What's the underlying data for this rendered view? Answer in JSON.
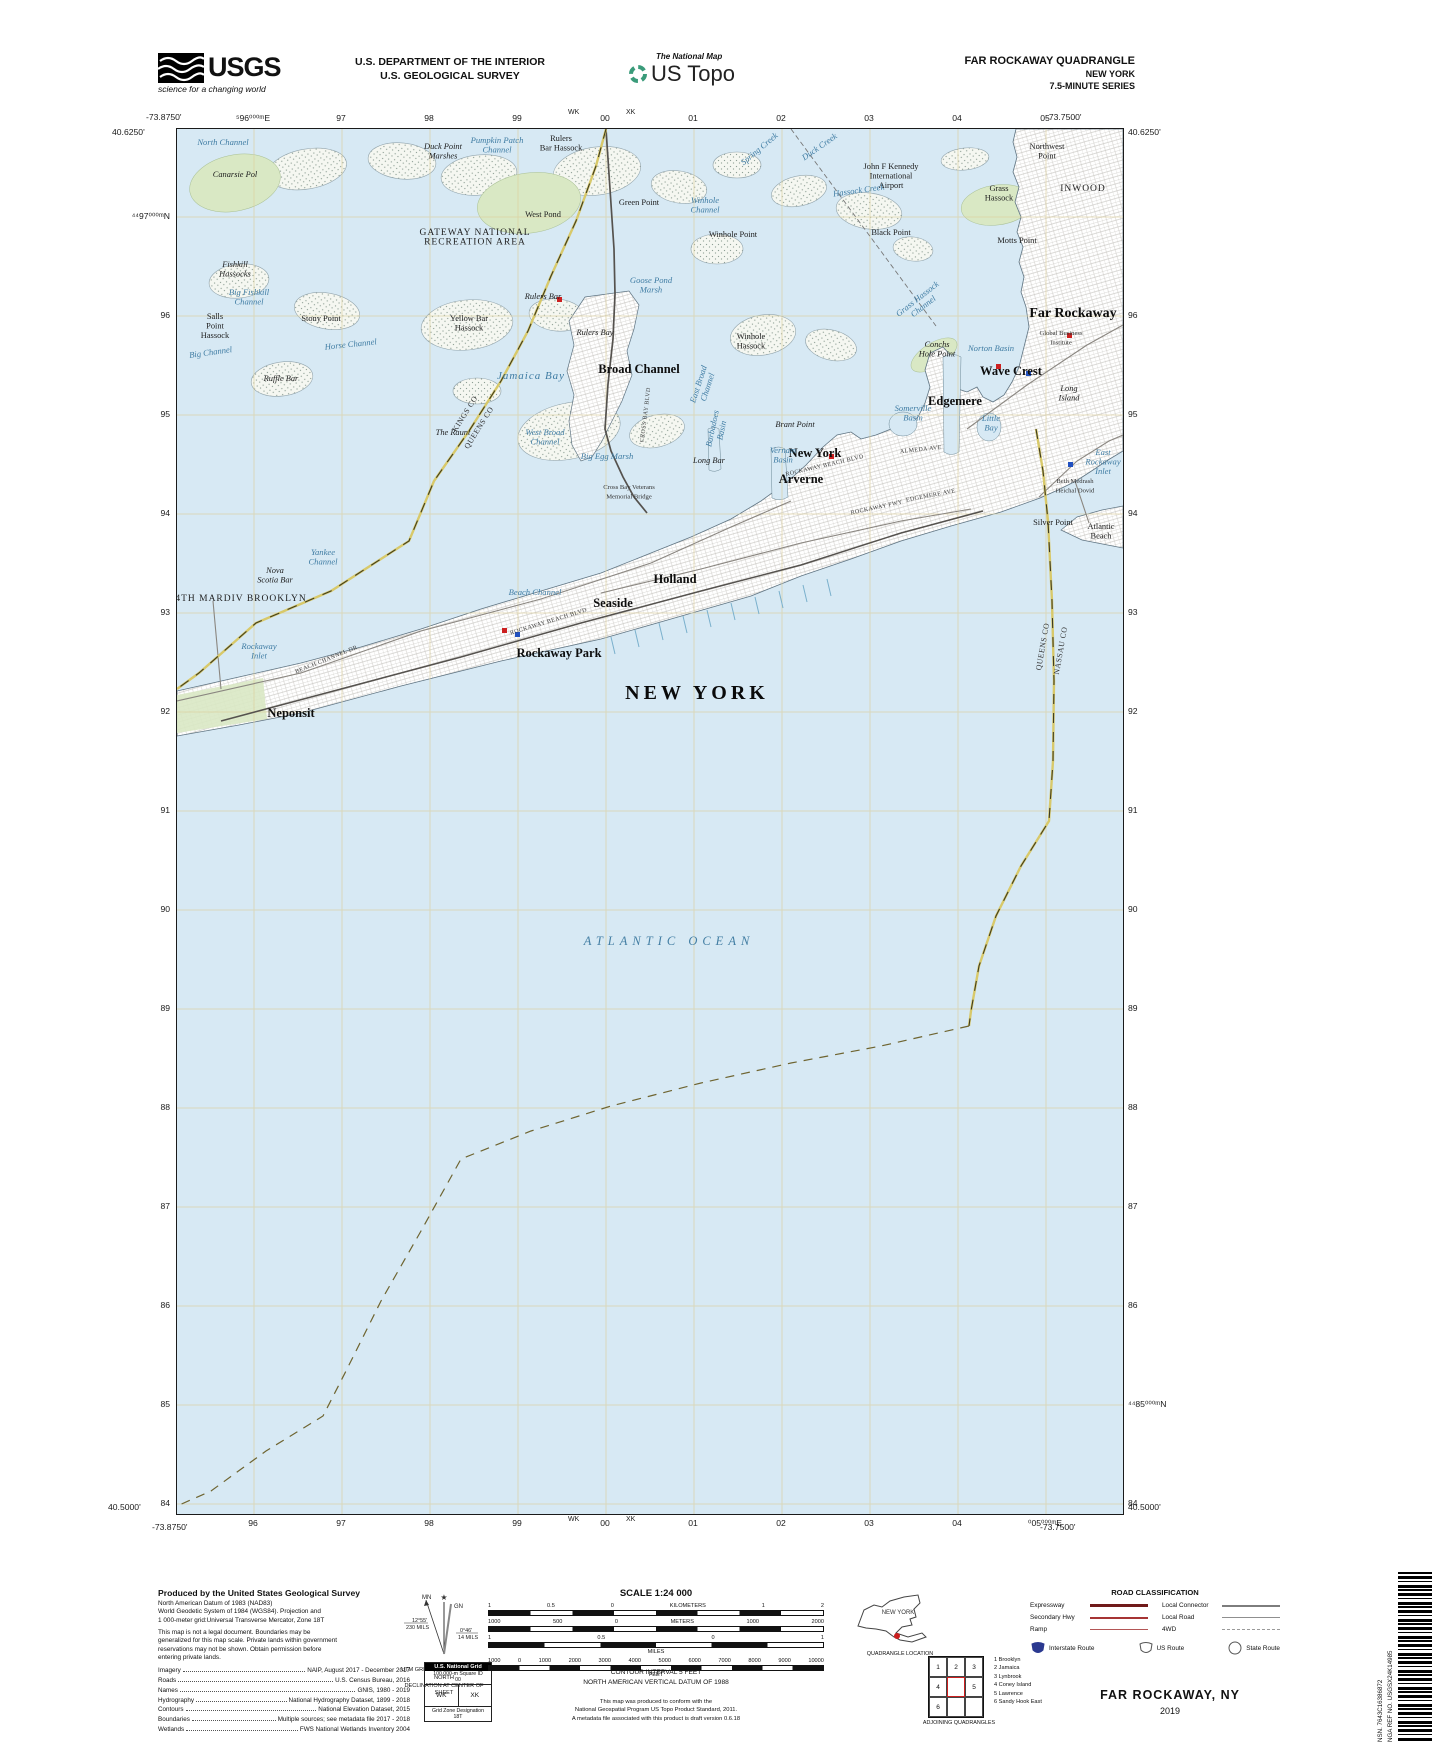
{
  "header": {
    "usgs": "USGS",
    "usgs_tag": "science for a changing world",
    "dept1": "U.S. DEPARTMENT OF THE INTERIOR",
    "dept2": "U.S. GEOLOGICAL SURVEY",
    "tnm": "The National Map",
    "ustopo": "US Topo",
    "quad": "FAR ROCKAWAY QUADRANGLE",
    "state": "NEW YORK",
    "series": "7.5-MINUTE SERIES"
  },
  "colors": {
    "water": "#d7e9f4",
    "grid": "#dccf9d",
    "green": "#d9e8c4",
    "boundary_yellow": "#d8c96a",
    "expressway_red": "#701a1a",
    "interstate_blue": "#2b3990",
    "poi_red": "#cc2020",
    "poi_blue": "#2050c0"
  },
  "map": {
    "corners": {
      "tl_lon": "-73.8750'",
      "tl_lat": "40.6250'",
      "tr_lon": "-73.7500'",
      "tr_lat": "40.6250'",
      "bl_lat": "40.5000'",
      "bl_lon": "-73.8750'",
      "br_lat": "40.5000'",
      "br_lon": "-73.7500'"
    },
    "top_grid": [
      "⁵96⁰⁰⁰ᵐE",
      "97",
      "98",
      "99",
      "00",
      "01",
      "02",
      "03",
      "04",
      "05"
    ],
    "bottom_grid": [
      "96",
      "97",
      "98",
      "99",
      "00",
      "01",
      "02",
      "03",
      "04",
      "⁰05⁰⁰⁰ᵐE"
    ],
    "left_grid": [
      "⁴⁴97⁰⁰⁰ᵐN",
      "96",
      "95",
      "94",
      "93",
      "92",
      "91",
      "90",
      "89",
      "88",
      "87",
      "86",
      "85",
      "84"
    ],
    "right_grid": [
      "96",
      "95",
      "94",
      "93",
      "92",
      "91",
      "90",
      "89",
      "88",
      "87",
      "86",
      "⁴⁴85⁰⁰⁰ᵐN",
      "84"
    ],
    "top_sq": [
      {
        "t": "WK",
        "x": 392
      },
      {
        "t": "XK",
        "x": 450
      }
    ],
    "bottom_sq": [
      {
        "t": "WK",
        "x": 392
      },
      {
        "t": "XK",
        "x": 450
      }
    ],
    "labels": [
      {
        "t": "North Channel",
        "x": 46,
        "y": 16,
        "c": "water"
      },
      {
        "t": "Canarsie Pol",
        "x": 58,
        "y": 48,
        "c": "pitalic"
      },
      {
        "t": "Duck Point\nMarshes",
        "x": 266,
        "y": 20,
        "c": "pitalic"
      },
      {
        "t": "Pumpkin Patch\nChannel",
        "x": 320,
        "y": 14,
        "c": "water"
      },
      {
        "t": "Rulers\nBar Hassock",
        "x": 384,
        "y": 12,
        "c": "place"
      },
      {
        "t": "Green Point",
        "x": 462,
        "y": 76,
        "c": "place"
      },
      {
        "t": "West Pond",
        "x": 366,
        "y": 88,
        "c": "place"
      },
      {
        "t": "Winhole\nChannel",
        "x": 528,
        "y": 74,
        "c": "water"
      },
      {
        "t": "Winhole Point",
        "x": 556,
        "y": 108,
        "c": "place"
      },
      {
        "t": "Spring Creek",
        "x": 584,
        "y": 22,
        "c": "water",
        "r": -40
      },
      {
        "t": "Duck Creek",
        "x": 644,
        "y": 20,
        "c": "water",
        "r": -35
      },
      {
        "t": "Hassock Creek",
        "x": 682,
        "y": 64,
        "c": "water",
        "r": -8
      },
      {
        "t": "John F Kennedy\nInternational\nAirport",
        "x": 714,
        "y": 40,
        "c": "place"
      },
      {
        "t": "Black Point",
        "x": 714,
        "y": 106,
        "c": "place"
      },
      {
        "t": "Grass\nHassock",
        "x": 822,
        "y": 62,
        "c": "place"
      },
      {
        "t": "Motts Point",
        "x": 840,
        "y": 114,
        "c": "place"
      },
      {
        "t": "Northwest\nPoint",
        "x": 870,
        "y": 20,
        "c": "place"
      },
      {
        "t": "INWOOD",
        "x": 906,
        "y": 62,
        "c": "area"
      },
      {
        "t": "GATEWAY NATIONAL\nRECREATION AREA",
        "x": 298,
        "y": 106,
        "c": "area"
      },
      {
        "t": "Fishkill\nHassocks",
        "x": 58,
        "y": 138,
        "c": "pitalic"
      },
      {
        "t": "Big Fishkill\nChannel",
        "x": 72,
        "y": 166,
        "c": "water"
      },
      {
        "t": "Stony Point",
        "x": 144,
        "y": 192,
        "c": "place"
      },
      {
        "t": "Yellow Bar\nHassock",
        "x": 292,
        "y": 192,
        "c": "place"
      },
      {
        "t": "Rulers Bay",
        "x": 418,
        "y": 206,
        "c": "pitalic"
      },
      {
        "t": "Rulers Bar",
        "x": 366,
        "y": 170,
        "c": "pitalic"
      },
      {
        "t": "Horse Channel",
        "x": 174,
        "y": 218,
        "c": "water",
        "r": -6
      },
      {
        "t": "Salls\nPoint\nHassock",
        "x": 38,
        "y": 190,
        "c": "place"
      },
      {
        "t": "Big Channel",
        "x": 34,
        "y": 226,
        "c": "water",
        "r": -8
      },
      {
        "t": "Ruffle Bar",
        "x": 104,
        "y": 252,
        "c": "pitalic"
      },
      {
        "t": "The Raunt",
        "x": 276,
        "y": 306,
        "c": "pitalic"
      },
      {
        "t": "Jamaica Bay",
        "x": 354,
        "y": 250,
        "c": "water11"
      },
      {
        "t": "Goose Pond\nMarsh",
        "x": 474,
        "y": 154,
        "c": "water"
      },
      {
        "t": "Broad Channel",
        "x": 462,
        "y": 244,
        "c": "town"
      },
      {
        "t": "Winhole\nHassock",
        "x": 574,
        "y": 210,
        "c": "place"
      },
      {
        "t": "West Broad\nChannel",
        "x": 368,
        "y": 306,
        "c": "water"
      },
      {
        "t": "Big Egg Marsh",
        "x": 430,
        "y": 330,
        "c": "water"
      },
      {
        "t": "East Broad\nChannel",
        "x": 524,
        "y": 256,
        "c": "water",
        "r": -72
      },
      {
        "t": "CROSS BAY BLVD",
        "x": 470,
        "y": 286,
        "c": "road",
        "r": -83
      },
      {
        "t": "Brant Point",
        "x": 618,
        "y": 298,
        "c": "pitalic"
      },
      {
        "t": "New York",
        "x": 638,
        "y": 328,
        "c": "town"
      },
      {
        "t": "Long Bar",
        "x": 532,
        "y": 334,
        "c": "pitalic"
      },
      {
        "t": "Conchs\nHole Point",
        "x": 760,
        "y": 218,
        "c": "pitalic"
      },
      {
        "t": "Grass Hassock\nChannel",
        "x": 742,
        "y": 172,
        "c": "water",
        "r": -38
      },
      {
        "t": "Norton Basin",
        "x": 814,
        "y": 222,
        "c": "water"
      },
      {
        "t": "Somerville\nBasin",
        "x": 736,
        "y": 282,
        "c": "water"
      },
      {
        "t": "Little\nBay",
        "x": 814,
        "y": 292,
        "c": "water"
      },
      {
        "t": "Far Rockaway",
        "x": 896,
        "y": 188,
        "c": "town14"
      },
      {
        "t": "Global Business\nInstitute",
        "x": 884,
        "y": 206,
        "c": "tiny"
      },
      {
        "t": "Wave Crest",
        "x": 834,
        "y": 246,
        "c": "town"
      },
      {
        "t": "Long\nIsland",
        "x": 892,
        "y": 262,
        "c": "pitalic"
      },
      {
        "t": "Edgemere",
        "x": 778,
        "y": 276,
        "c": "town"
      },
      {
        "t": "Beth Medrash\nHeichal Dovid",
        "x": 898,
        "y": 354,
        "c": "tiny"
      },
      {
        "t": "ALMEDA AVE",
        "x": 744,
        "y": 322,
        "c": "road",
        "r": -6
      },
      {
        "t": "Vernam\nBasin",
        "x": 606,
        "y": 324,
        "c": "water"
      },
      {
        "t": "Arverne",
        "x": 624,
        "y": 354,
        "c": "town"
      },
      {
        "t": "Barbadoes\nBasin",
        "x": 538,
        "y": 300,
        "c": "water",
        "r": -78
      },
      {
        "t": "ROCKAWAY BEACH BLVD",
        "x": 372,
        "y": 494,
        "c": "road",
        "r": -17
      },
      {
        "t": "ROCKAWAY BEACH BLVD",
        "x": 648,
        "y": 338,
        "c": "road",
        "r": -13
      },
      {
        "t": "ROCKAWAY FWY",
        "x": 700,
        "y": 380,
        "c": "road",
        "r": -12
      },
      {
        "t": "EDGEMERE AVE",
        "x": 754,
        "y": 368,
        "c": "road",
        "r": -11
      },
      {
        "t": "BEACH CHANNEL DR",
        "x": 150,
        "y": 532,
        "c": "road",
        "r": -22
      },
      {
        "t": "Cross Bay Veterans\nMemorial Bridge",
        "x": 452,
        "y": 360,
        "c": "tiny"
      },
      {
        "t": "Beach Channel",
        "x": 358,
        "y": 466,
        "c": "water"
      },
      {
        "t": "Holland",
        "x": 498,
        "y": 454,
        "c": "town"
      },
      {
        "t": "Seaside",
        "x": 436,
        "y": 478,
        "c": "town"
      },
      {
        "t": "Rockaway Park",
        "x": 382,
        "y": 528,
        "c": "town"
      },
      {
        "t": "Neponsit",
        "x": 114,
        "y": 588,
        "c": "town"
      },
      {
        "t": "Rockaway\nInlet",
        "x": 82,
        "y": 520,
        "c": "water"
      },
      {
        "t": "Yankee\nChannel",
        "x": 146,
        "y": 426,
        "c": "water"
      },
      {
        "t": "Nova\nScotia Bar",
        "x": 98,
        "y": 444,
        "c": "pitalic"
      },
      {
        "t": "4TH MARDIV BROOKLYN",
        "x": 64,
        "y": 472,
        "c": "area"
      },
      {
        "t": "KINGS CO",
        "x": 290,
        "y": 286,
        "c": "county",
        "r": -58
      },
      {
        "t": "QUEENS CO",
        "x": 304,
        "y": 300,
        "c": "county",
        "r": -58
      },
      {
        "t": "QUEENS CO",
        "x": 868,
        "y": 518,
        "c": "county",
        "r": -80
      },
      {
        "t": "NASSAU CO",
        "x": 886,
        "y": 522,
        "c": "county",
        "r": -80
      },
      {
        "t": "NEW YORK",
        "x": 520,
        "y": 570,
        "c": "big"
      },
      {
        "t": "ATLANTIC OCEAN",
        "x": 492,
        "y": 816,
        "c": "ocean"
      },
      {
        "t": "Silver Point",
        "x": 876,
        "y": 396,
        "c": "place"
      },
      {
        "t": "Atlantic\nBeach",
        "x": 924,
        "y": 400,
        "c": "place"
      },
      {
        "t": "East\nRockaway\nInlet",
        "x": 926,
        "y": 326,
        "c": "water"
      }
    ]
  },
  "footer": {
    "produced": "Produced by the United States Geological Survey",
    "datum": "North American Datum of 1983 (NAD83)\nWorld Geodetic System of 1984 (WGS84).  Projection and\n1 000-meter grid:Universal Transverse Mercator, Zone 18T",
    "legal": "This map is not a legal document. Boundaries may be\ngeneralized for this map scale. Private lands within government\nreservations may not be shown. Obtain permission before\nentering private lands.",
    "attribution": [
      [
        "Imagery",
        "NAIP, August 2017 - December 2017"
      ],
      [
        "Roads",
        "U.S. Census Bureau, 2016"
      ],
      [
        "Names",
        "GNIS, 1980 - 2019"
      ],
      [
        "Hydrography",
        "National Hydrography Dataset, 1899 - 2018"
      ],
      [
        "Contours",
        "National Elevation Dataset, 2015"
      ],
      [
        "Boundaries",
        "Multiple sources; see metadata file 2017 - 2018"
      ],
      [
        "Wetlands",
        "FWS National Wetlands Inventory 2004"
      ]
    ],
    "decl": {
      "mn": "MN",
      "gn": "GN",
      "mn_deg": "12°55'",
      "mn_mils": "230 MILS",
      "gn_deg": "0°46'",
      "gn_mils": "14 MILS",
      "cap": "UTM GRID AND 2019 MAGNETIC NORTH\nDECLINATION AT CENTER OF SHEET"
    },
    "usng": {
      "title": "U.S. National Grid",
      "sub": "100,000-m Square ID",
      "center": "00",
      "left": "WK",
      "right": "XK",
      "f": "Grid Zone Designation\n18T"
    },
    "scale_title": "SCALE 1:24 000",
    "bars": [
      {
        "ticks": [
          "1",
          "0.5",
          "0",
          "KILOMETERS",
          "1",
          "2"
        ],
        "segs": 8,
        "unit": ""
      },
      {
        "ticks": [
          "1000",
          "500",
          "0",
          "METERS",
          "1000",
          "2000"
        ],
        "segs": 8,
        "unit": ""
      },
      {
        "ticks": [
          "1",
          "0.5",
          "0",
          "1"
        ],
        "segs": 6,
        "unit": "MILES"
      },
      {
        "ticks": [
          "1000",
          "0",
          "1000",
          "2000",
          "3000",
          "4000",
          "5000",
          "6000",
          "7000",
          "8000",
          "9000",
          "10000"
        ],
        "segs": 11,
        "unit": "FEET"
      }
    ],
    "contour": "CONTOUR INTERVAL 5 FEET\nNORTH AMERICAN VERTICAL DATUM OF 1988",
    "standard": "This map was produced to conform with the\nNational Geospatial Program US Topo Product Standard, 2011.\nA metadata file associated with this product is draft version 0.6.18",
    "ny_label": "NEW YORK",
    "quad_loc": "QUADRANGLE LOCATION",
    "adj_numbers": [
      "1",
      "2",
      "3",
      "4",
      "",
      "5",
      "6",
      "",
      ""
    ],
    "adj_names": [
      "1 Brooklyn",
      "2 Jamaica",
      "3 Lynbrook",
      "4 Coney Island",
      "5 Lawrence",
      "6 Sandy Hook East"
    ],
    "adj_cap": "ADJOINING QUADRANGLES",
    "road_class": {
      "title": "ROAD CLASSIFICATION",
      "left": [
        [
          "Expressway",
          "expwy"
        ],
        [
          "Secondary Hwy",
          "sec"
        ],
        [
          "Ramp",
          "ramp"
        ]
      ],
      "right": [
        [
          "Local Connector",
          "conn"
        ],
        [
          "Local Road",
          "locrd"
        ],
        [
          "4WD",
          "fwd"
        ]
      ],
      "shields": [
        [
          "Interstate Route",
          "interstate"
        ],
        [
          "US Route",
          "usroute"
        ],
        [
          "State Route",
          "state"
        ]
      ]
    },
    "sheet": "FAR ROCKAWAY,  NY",
    "year": "2019",
    "nsn": "NSN.  7643C16386872",
    "nga": "NGA REF NO.  USGSX24K14985"
  }
}
